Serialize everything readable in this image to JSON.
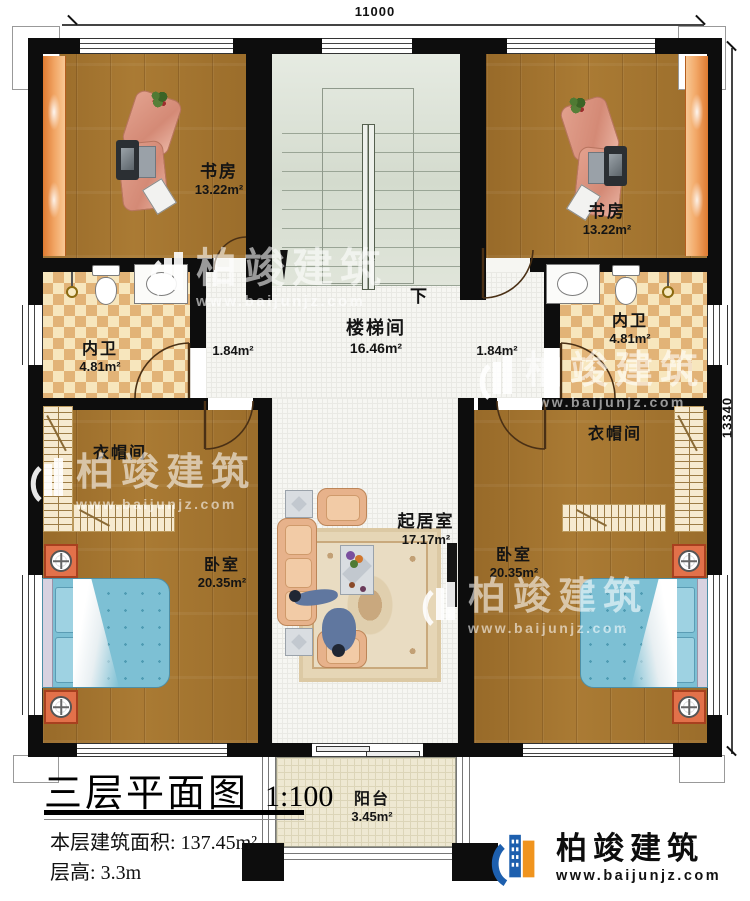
{
  "dimensions": {
    "top": "11000",
    "right": "13340"
  },
  "rooms": {
    "study_left": {
      "name": "书房",
      "area": "13.22m²"
    },
    "study_right": {
      "name": "书房",
      "area": "13.22m²"
    },
    "stair": {
      "name": "楼梯间",
      "area": "16.46m²",
      "down": "下"
    },
    "hall_left": {
      "area": "1.84m²"
    },
    "hall_right": {
      "area": "1.84m²"
    },
    "bath_left": {
      "name": "内卫",
      "area": "4.81m²"
    },
    "bath_right": {
      "name": "内卫",
      "area": "4.81m²"
    },
    "cloak_left": {
      "name": "衣帽间"
    },
    "cloak_right": {
      "name": "衣帽间"
    },
    "bed_left": {
      "name": "卧室",
      "area": "20.35m²"
    },
    "bed_right": {
      "name": "卧室",
      "area": "20.35m²"
    },
    "living": {
      "name": "起居室",
      "area": "17.17m²"
    },
    "balcony": {
      "name": "阳台",
      "area": "3.45m²"
    }
  },
  "title_block": {
    "title": "三层平面图",
    "scale": "1:100",
    "area_label": "本层建筑面积:",
    "area_value": "137.45m²",
    "height_label": "层高:",
    "height_value": "3.3m"
  },
  "watermark": {
    "brand": "柏竣建筑",
    "url": "www.baijunjz.com"
  },
  "logo": {
    "brand": "柏竣建筑",
    "url": "www.baijunjz.com"
  }
}
